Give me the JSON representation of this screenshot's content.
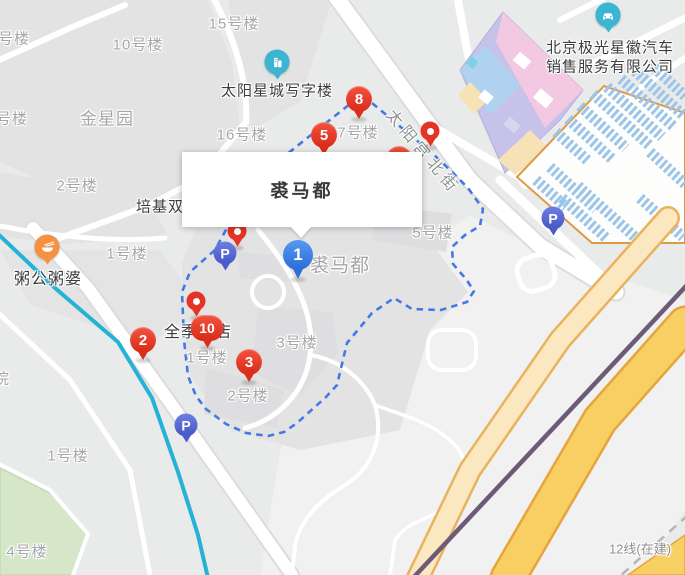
{
  "popup": {
    "title": "裘马都"
  },
  "street_label": {
    "text": "太阳宫北街"
  },
  "subway_label": {
    "text": "12线(在建)"
  },
  "colors": {
    "red_marker": "#e43425",
    "blue_marker": "#3b82e6",
    "parking_marker": "#4a5cc8",
    "poi_teal": "#3cb5d3",
    "poi_orange": "#f59140",
    "boundary_dash": "#4479e2",
    "cyan_line": "#25b2d6",
    "purple_line": "#6d5a78",
    "road_yellow": "#f8cf62"
  },
  "numbered_markers": [
    {
      "n": "1",
      "style": "blue",
      "x": 298,
      "y": 255
    },
    {
      "n": "2",
      "style": "red",
      "x": 143,
      "y": 340
    },
    {
      "n": "3",
      "style": "red",
      "x": 249,
      "y": 362
    },
    {
      "n": "5",
      "style": "red",
      "x": 324,
      "y": 135
    },
    {
      "n": "8",
      "style": "red",
      "x": 359,
      "y": 99
    },
    {
      "n": "10",
      "style": "red",
      "x": 207,
      "y": 328,
      "wide": true
    },
    {
      "n": "4",
      "style": "red",
      "x": 399,
      "y": 159,
      "hidden": true
    }
  ],
  "dot_markers": [
    {
      "x": 430,
      "y": 131
    },
    {
      "x": 196,
      "y": 301
    },
    {
      "x": 237,
      "y": 231,
      "hidden": true
    }
  ],
  "parking_markers": [
    {
      "label": "P",
      "x": 225,
      "y": 253
    },
    {
      "label": "P",
      "x": 186,
      "y": 425
    },
    {
      "label": "P",
      "x": 553,
      "y": 218
    }
  ],
  "poi_markers": [
    {
      "icon": "car-dealer-icon",
      "color": "#3cb5d3",
      "x": 608,
      "y": 15
    },
    {
      "icon": "office-building-icon",
      "color": "#3cb5d3",
      "x": 277,
      "y": 62
    },
    {
      "icon": "restaurant-icon",
      "color": "#f59140",
      "x": 47,
      "y": 247
    }
  ],
  "area_labels": [
    {
      "text": "号楼",
      "x": 14,
      "y": 38,
      "size": 15
    },
    {
      "text": "10号楼",
      "x": 138,
      "y": 44,
      "size": 15
    },
    {
      "text": "15号楼",
      "x": 234,
      "y": 23,
      "size": 15
    },
    {
      "text": "金星园",
      "x": 107,
      "y": 117,
      "size": 17
    },
    {
      "text": "号楼",
      "x": 12,
      "y": 118,
      "size": 15
    },
    {
      "text": "16号楼",
      "x": 242,
      "y": 134,
      "size": 15
    },
    {
      "text": "7号楼",
      "x": 358,
      "y": 132,
      "size": 15
    },
    {
      "text": "2号楼",
      "x": 77,
      "y": 185,
      "size": 15
    },
    {
      "text": "1号楼",
      "x": 127,
      "y": 253,
      "size": 15
    },
    {
      "text": "5号楼",
      "x": 433,
      "y": 232,
      "size": 15
    },
    {
      "text": "裘马都",
      "x": 340,
      "y": 264,
      "size": 19
    },
    {
      "text": "3号楼",
      "x": 297,
      "y": 342,
      "size": 15
    },
    {
      "text": "1号楼",
      "x": 207,
      "y": 357,
      "size": 15
    },
    {
      "text": "院",
      "x": 2,
      "y": 378,
      "size": 15
    },
    {
      "text": "2号楼",
      "x": 248,
      "y": 395,
      "size": 15
    },
    {
      "text": "1号楼",
      "x": 68,
      "y": 455,
      "size": 15
    },
    {
      "text": "4号楼",
      "x": 27,
      "y": 551,
      "size": 15
    }
  ],
  "poi_labels": [
    {
      "text": "太阳星城写字楼",
      "x": 277,
      "y": 90,
      "size": 15
    },
    {
      "text": "北京极光星徽汽车",
      "x": 610,
      "y": 47,
      "size": 15
    },
    {
      "text": "销售服务有限公司",
      "x": 610,
      "y": 66,
      "size": 15
    },
    {
      "text": "培基双",
      "x": 160,
      "y": 206,
      "size": 15
    },
    {
      "text": "粥公粥婆",
      "x": 48,
      "y": 277,
      "size": 16
    },
    {
      "text": "全季酒店",
      "x": 198,
      "y": 330,
      "size": 16
    }
  ]
}
